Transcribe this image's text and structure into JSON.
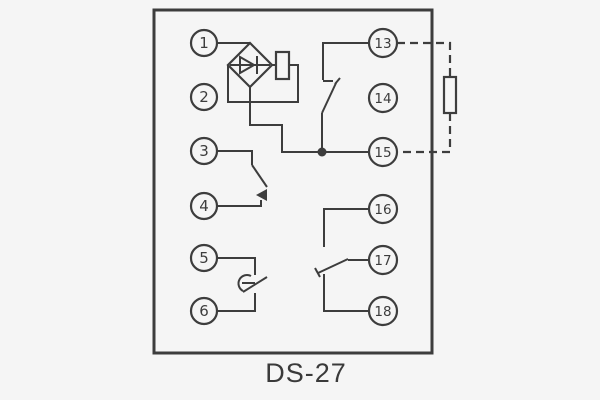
{
  "diagram": {
    "caption": "DS-27",
    "terminals": {
      "left": [
        "1",
        "2",
        "3",
        "4",
        "5",
        "6"
      ],
      "right": [
        "13",
        "14",
        "15",
        "16",
        "17",
        "18"
      ]
    },
    "icons": {
      "bridge": "bridge-rectifier-diamond",
      "diode": "diode-arrow-right",
      "coil": "coil-resistor-box",
      "external_resistor": "external-resistor-box",
      "junction": "solder-junction-dot",
      "external_wiring_style": "dashed"
    },
    "colors": {
      "line": "#3d3d3d",
      "background": "#f5f5f5"
    }
  }
}
